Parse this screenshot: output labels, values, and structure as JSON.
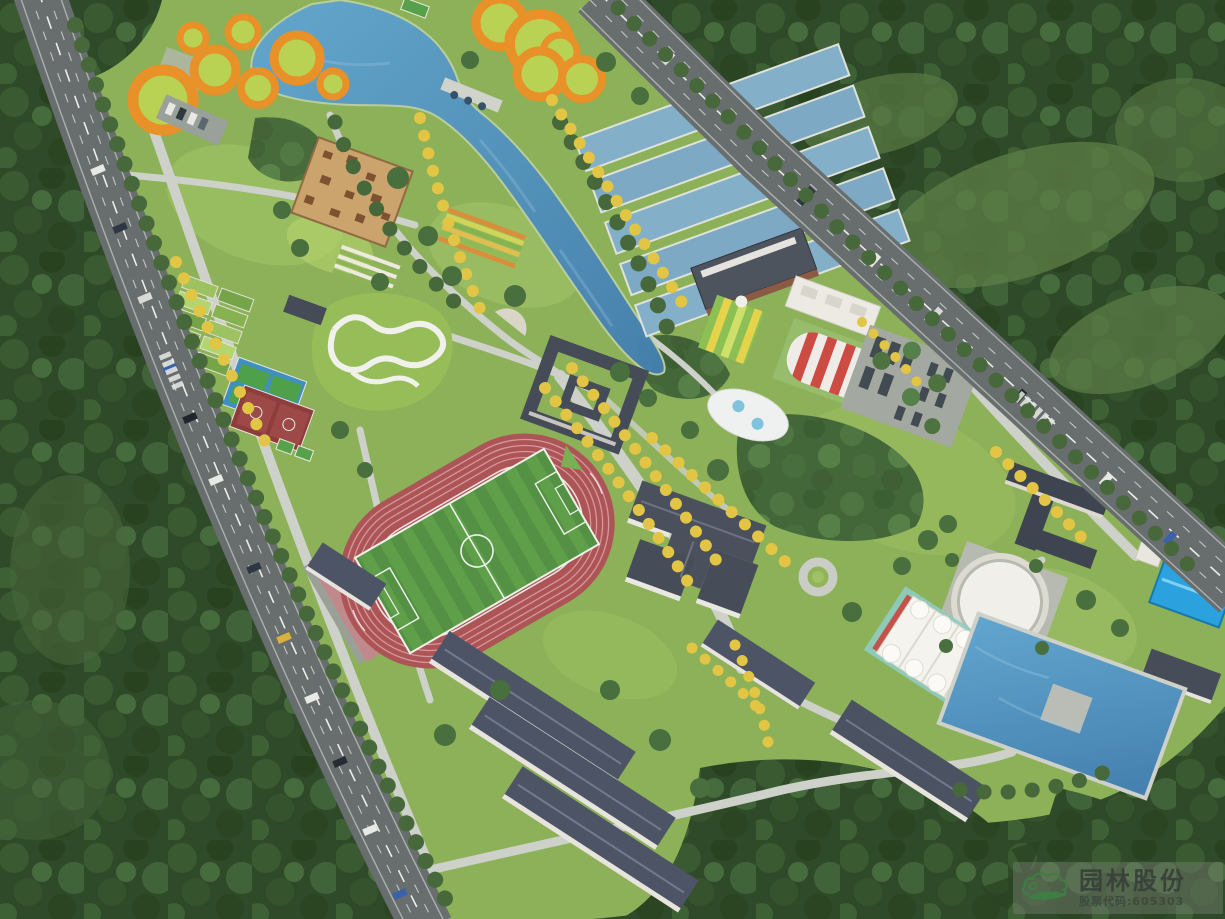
{
  "image": {
    "type": "aerial-architectural-rendering",
    "subject": "campus sports-park master plan, bird's-eye view",
    "orientation": "site band runs diagonally between two arterial roads surrounded by forest"
  },
  "watermark": {
    "company_name": "园林股份",
    "stock_code": "股票代码:605303",
    "logo": "cloud-landscape-logo",
    "logo_green": "#3e7d43",
    "name_color": "#39433a",
    "code_color": "#3e4a3f"
  },
  "features": {
    "lake": "winding central lake",
    "orange_rings": "orange circular play lawns",
    "treatment_pools": "terraced water-treatment pools",
    "wood_plaza": "timber pixel plaza",
    "pump_track": "white pump-track mound",
    "garden_plots": "allotment garden plots",
    "tennis_courts": "blue tennis courts",
    "basketball_courts": "red basketball courts",
    "stadium": "400m track with soccer field",
    "courtyard_building": "quadrangle courtyard building",
    "main_building": "main academic building",
    "dormitories": "dormitory rows",
    "air_dome": "red-white striped air dome",
    "tent_courts": "white membrane tennis canopy",
    "circular_plaza": "white circular plaza",
    "pond": "rectangular reservoir pond",
    "blue_canopy": "blue playground canopy",
    "parking": "bus parking grove",
    "roads": "tree-lined arterial roads with traffic"
  },
  "palette": {
    "forest_dark": "#2f4a28",
    "campus_grass": "#8cb158",
    "lawn_light": "#a2c468",
    "water": "#4f93c2",
    "pool_water": "#84afc9",
    "road": "#686d6e",
    "path": "#cdd1c9",
    "track_red": "#ad5456",
    "field_green": "#5f9f49",
    "roof_dark": "#4a505c",
    "ring_orange": "#e79128",
    "ginkgo_yellow": "#e2c544",
    "canopy_blue": "#2ba2de",
    "dome_red": "#cc4b42"
  }
}
